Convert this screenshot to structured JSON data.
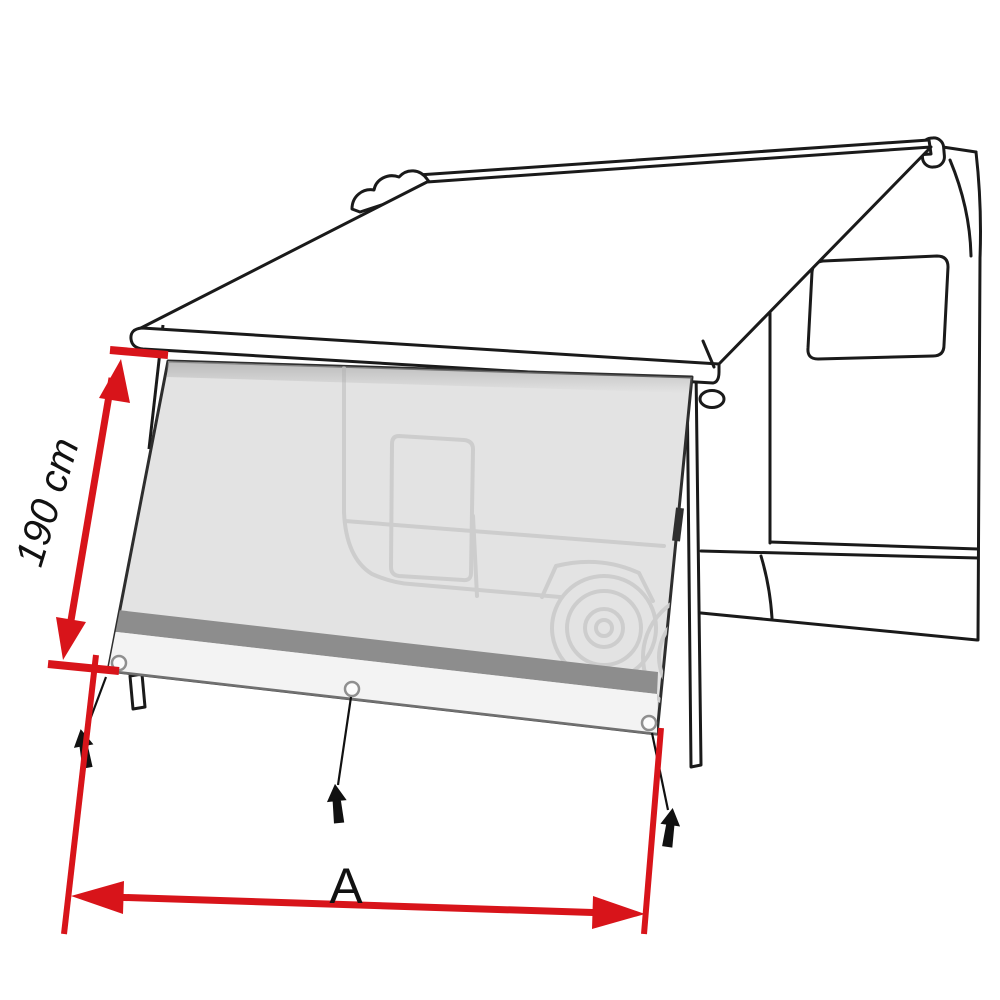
{
  "diagram": {
    "description": "Camper van with extended awning and front sun-view side panel, dimension diagram",
    "dimensions": {
      "height": {
        "label": "190 cm"
      },
      "width": {
        "label": "A"
      }
    }
  },
  "colors": {
    "accent_red": "#d8141a",
    "outline": "#1a1a1a",
    "panel_fill": "#e3e3e3",
    "panel_sketch_line": "#cdcdcd",
    "stripe_gray": "#8d8d8d",
    "skirt_light": "#f3f3f3",
    "background": "#ffffff"
  },
  "icons": {
    "grommet": "grommet-icon (small circle eyelet)",
    "ground_peg": "ground-peg-icon (black tent peg / nail)"
  }
}
